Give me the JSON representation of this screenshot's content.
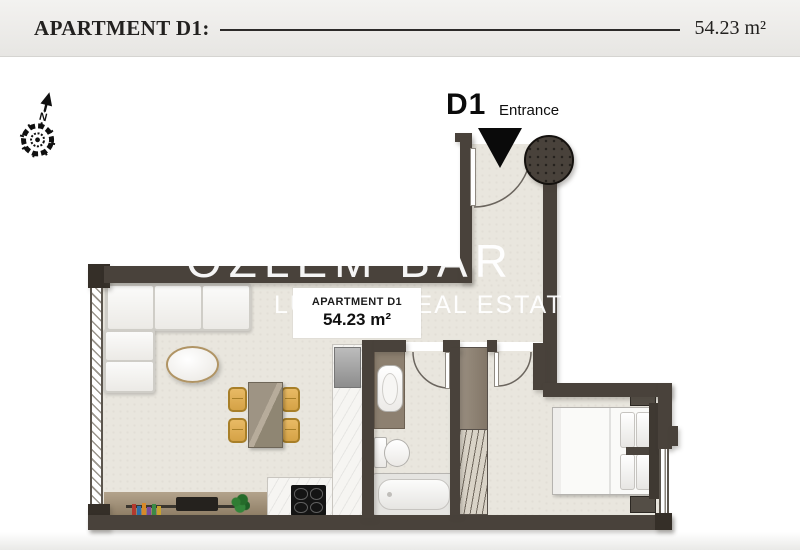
{
  "header": {
    "title": "APARTMENT D1:",
    "area": "54.23 m²"
  },
  "compass": {
    "north": "N"
  },
  "entrance": {
    "unit": "D1",
    "label": "Entrance"
  },
  "watermark": {
    "line1": "OZLEM BAR",
    "line2": "LUXURY REAL ESTATE"
  },
  "badge": {
    "title": "APARTMENT D1",
    "area": "54.23 m²"
  },
  "colors": {
    "wall": "#49423b",
    "wallDark": "#352f28",
    "floor": "#e9e6de",
    "marble": "#f6f5f2",
    "wood": "#8d8070",
    "woodFloor": "#a28f73",
    "chair": "#d5a246",
    "headerBg": "#f3f2f0",
    "ink": "#22211f"
  }
}
